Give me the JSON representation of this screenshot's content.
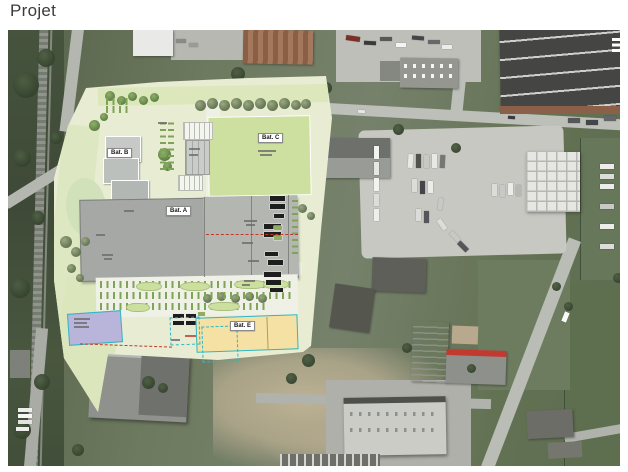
{
  "slide": {
    "title": "Projet"
  },
  "site_plan": {
    "labels": {
      "bat_a": "Bat. A",
      "bat_b": "Bat. B",
      "bat_c": "Bat. C",
      "bat_e": "Bat. E"
    }
  },
  "colors": {
    "plan_base": "#e7ecd2",
    "sports_field_green": "#cde09f",
    "building_gray": "#a9aca8",
    "bat_e_yellow": "#f6e1a4",
    "bat_d_lavender": "#b9b4d9",
    "outline_teal": "#2fb6c6",
    "marking_red": "#c0392b"
  }
}
